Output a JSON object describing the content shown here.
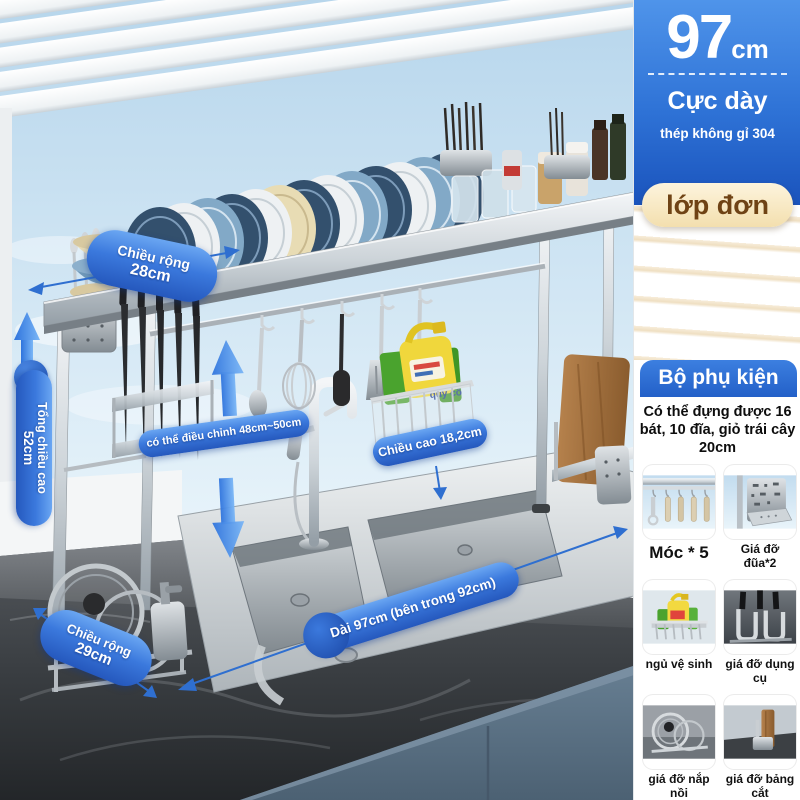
{
  "panel": {
    "size_value": "97",
    "size_unit": "cm",
    "thickness_title": "Cực dày",
    "material": "thép không gỉ 304",
    "layer_badge": "lớp đơn",
    "accessories_header": "Bộ phụ kiện",
    "capacity_text": "Có thể đựng được 16 bát, 10 đĩa, giỏ trái cây 20cm",
    "accessories": [
      {
        "label": "Móc * 5",
        "icon": "hooks-icon"
      },
      {
        "label": "Giá đỡ đũa*2",
        "icon": "chopstick-holder-icon"
      },
      {
        "label": "ngủ vệ sinh",
        "icon": "cleaning-basket-icon"
      },
      {
        "label": "giá đỡ dụng cụ",
        "icon": "utensil-rack-icon"
      },
      {
        "label": "giá đỡ nắp nồi",
        "icon": "pot-lid-holder-icon"
      },
      {
        "label": "giá đỡ bảng cắt",
        "icon": "cutting-board-holder-icon"
      }
    ]
  },
  "annotations": {
    "width_top": {
      "label": "Chiều rộng",
      "value": "28cm"
    },
    "total_height": {
      "label": "Tổng chiều cao",
      "value": "52cm"
    },
    "adjustable": {
      "label": "có thể điều chỉnh 48cm~50cm"
    },
    "height": {
      "label": "Chiều cao 18,2cm"
    },
    "length": {
      "label": "Dài 97cm (bên trong 92cm)"
    },
    "width_bottom": {
      "label": "Chiều rộng",
      "value": "29cm"
    },
    "bottle_label": "quý cô"
  },
  "colors": {
    "annotation_blue": "#2a62c8",
    "panel_blue": "#2e72d6",
    "badge_cream": "#f6e8c6",
    "badge_text_brown": "#6f4315",
    "cabinet_blue_gray": "#5c7487"
  }
}
